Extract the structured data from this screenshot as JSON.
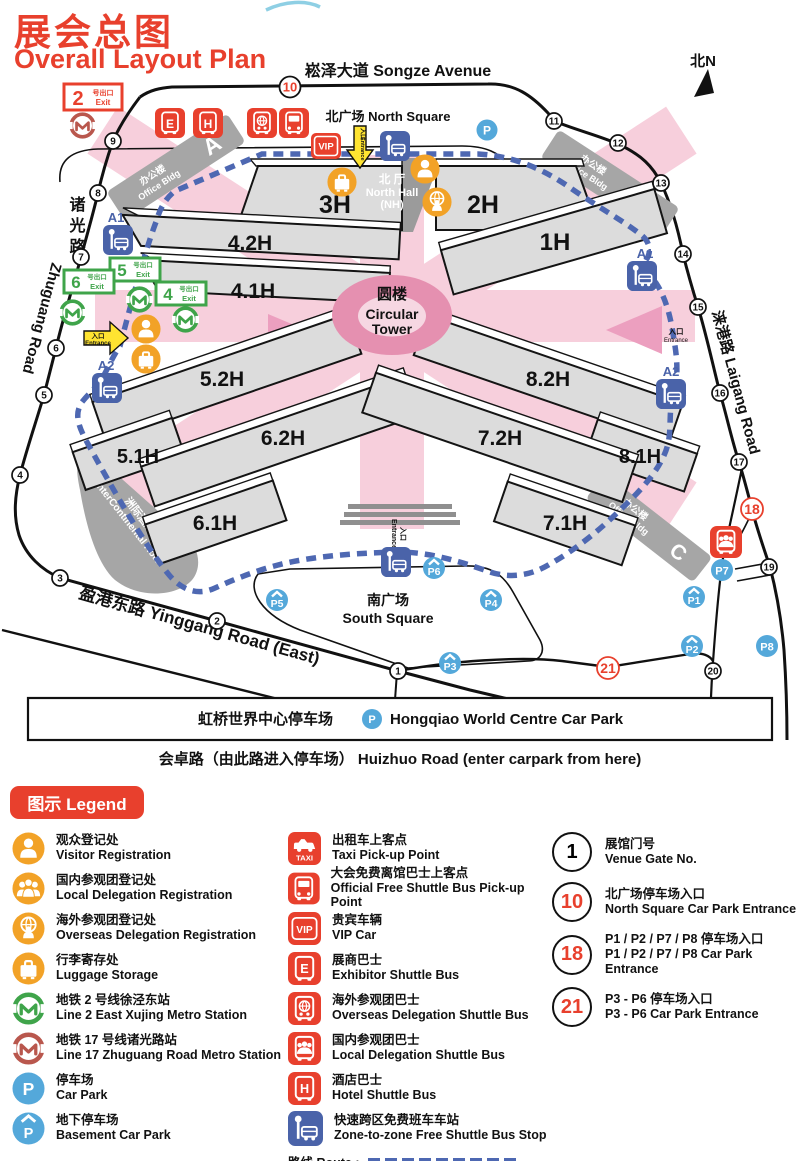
{
  "title": {
    "zh": "展会总图",
    "en": "Overall Layout Plan"
  },
  "compass": "北N",
  "map": {
    "roads": {
      "songze": "崧泽大道 Songze Avenue",
      "zhuguang_zh": "诸光路",
      "zhuguang_en": "Zhuguang Road",
      "laigang": "涞港路 Laigang Road",
      "yinggang": "盈港东路 Yinggang Road (East)",
      "huizhuo": "会卓路（由此路进入停车场） Huizhuo Road (enter carpark from here)"
    },
    "areas": {
      "north_square": "北广场 North Square",
      "south_square_zh": "南广场",
      "south_square_en": "South Square",
      "north_hall_zh": "北 厅",
      "north_hall_en": "North Hall",
      "north_hall_code": "(NH)",
      "tower_zh": "圆楼",
      "tower_en1": "Circular",
      "tower_en2": "Tower",
      "hotel_zh": "洲际酒店",
      "hotel_en": "InterContinental Hotel",
      "office_zh": "办公楼",
      "office_en": "Office Bldg",
      "office_a": "A",
      "office_b": "B",
      "office_c": "C",
      "carpark_zh": "虹桥世界中心停车场",
      "carpark_en": "Hongqiao World Centre Car Park"
    },
    "halls": {
      "h1": "1H",
      "h2": "2H",
      "h3": "3H",
      "h41": "4.1H",
      "h42": "4.2H",
      "h51": "5.1H",
      "h52": "5.2H",
      "h61": "6.1H",
      "h62": "6.2H",
      "h71": "7.1H",
      "h72": "7.2H",
      "h81": "8.1H",
      "h82": "8.2H"
    },
    "gates": [
      "1",
      "2",
      "3",
      "4",
      "5",
      "6",
      "7",
      "8",
      "9",
      "10",
      "11",
      "12",
      "13",
      "14",
      "15",
      "16",
      "17",
      "18",
      "19",
      "20",
      "21"
    ],
    "parking": {
      "p": "P",
      "p1": "P1",
      "p2": "P2",
      "p3": "P3",
      "p4": "P4",
      "p5": "P5",
      "p6": "P6",
      "p7": "P7",
      "p8": "P8"
    },
    "exits": {
      "n2": "2",
      "n4": "4",
      "n5": "5",
      "n6": "6",
      "zh": "号出口",
      "en": "Exit"
    },
    "entrance": {
      "zh": "入口",
      "en": "Entrance"
    },
    "stops": {
      "a1": "A1",
      "a2": "A2"
    },
    "glyphs": {
      "e": "E",
      "h": "H",
      "vip": "VIP",
      "taxi": "TAXI"
    }
  },
  "legend": {
    "header": "图示 Legend",
    "route_label": "路线 Route :",
    "col1": [
      {
        "zh": "观众登记处",
        "en": "Visitor Registration"
      },
      {
        "zh": "国内参观团登记处",
        "en": "Local Delegation Registration"
      },
      {
        "zh": "海外参观团登记处",
        "en": "Overseas Delegation Registration"
      },
      {
        "zh": "行李寄存处",
        "en": "Luggage Storage"
      },
      {
        "zh": "地铁 2 号线徐泾东站",
        "en": "Line 2 East Xujing Metro Station"
      },
      {
        "zh": "地铁 17 号线诸光路站",
        "en": "Line 17 Zhuguang Road Metro Station"
      },
      {
        "zh": "停车场",
        "en": "Car Park"
      },
      {
        "zh": "地下停车场",
        "en": "Basement Car Park"
      }
    ],
    "col2": [
      {
        "zh": "出租车上客点",
        "en": "Taxi Pick-up Point"
      },
      {
        "zh": "大会免费离馆巴士上客点",
        "en": "Official Free Shuttle Bus Pick-up Point"
      },
      {
        "zh": "贵宾车辆",
        "en": "VIP Car"
      },
      {
        "zh": "展商巴士",
        "en": "Exhibitor Shuttle Bus"
      },
      {
        "zh": "海外参观团巴士",
        "en": "Overseas Delegation Shuttle Bus"
      },
      {
        "zh": "国内参观团巴士",
        "en": "Local Delegation Shuttle Bus"
      },
      {
        "zh": "酒店巴士",
        "en": "Hotel Shuttle Bus"
      },
      {
        "zh": "快速跨区免费班车车站",
        "en": "Zone-to-zone Free Shuttle Bus Stop"
      }
    ],
    "col3": [
      {
        "num": "1",
        "zh": "展馆门号",
        "en": "Venue Gate No.",
        "red": false
      },
      {
        "num": "10",
        "zh": "北广场停车场入口",
        "en": "North Square Car Park Entrance",
        "red": true
      },
      {
        "num": "18",
        "zh": "P1 / P2 / P7 / P8 停车场入口",
        "en": "P1 / P2 / P7 / P8 Car Park Entrance",
        "red": true
      },
      {
        "num": "21",
        "zh": "P3 - P6 停车场入口",
        "en": "P3 - P6 Car Park Entrance",
        "red": true
      }
    ]
  }
}
